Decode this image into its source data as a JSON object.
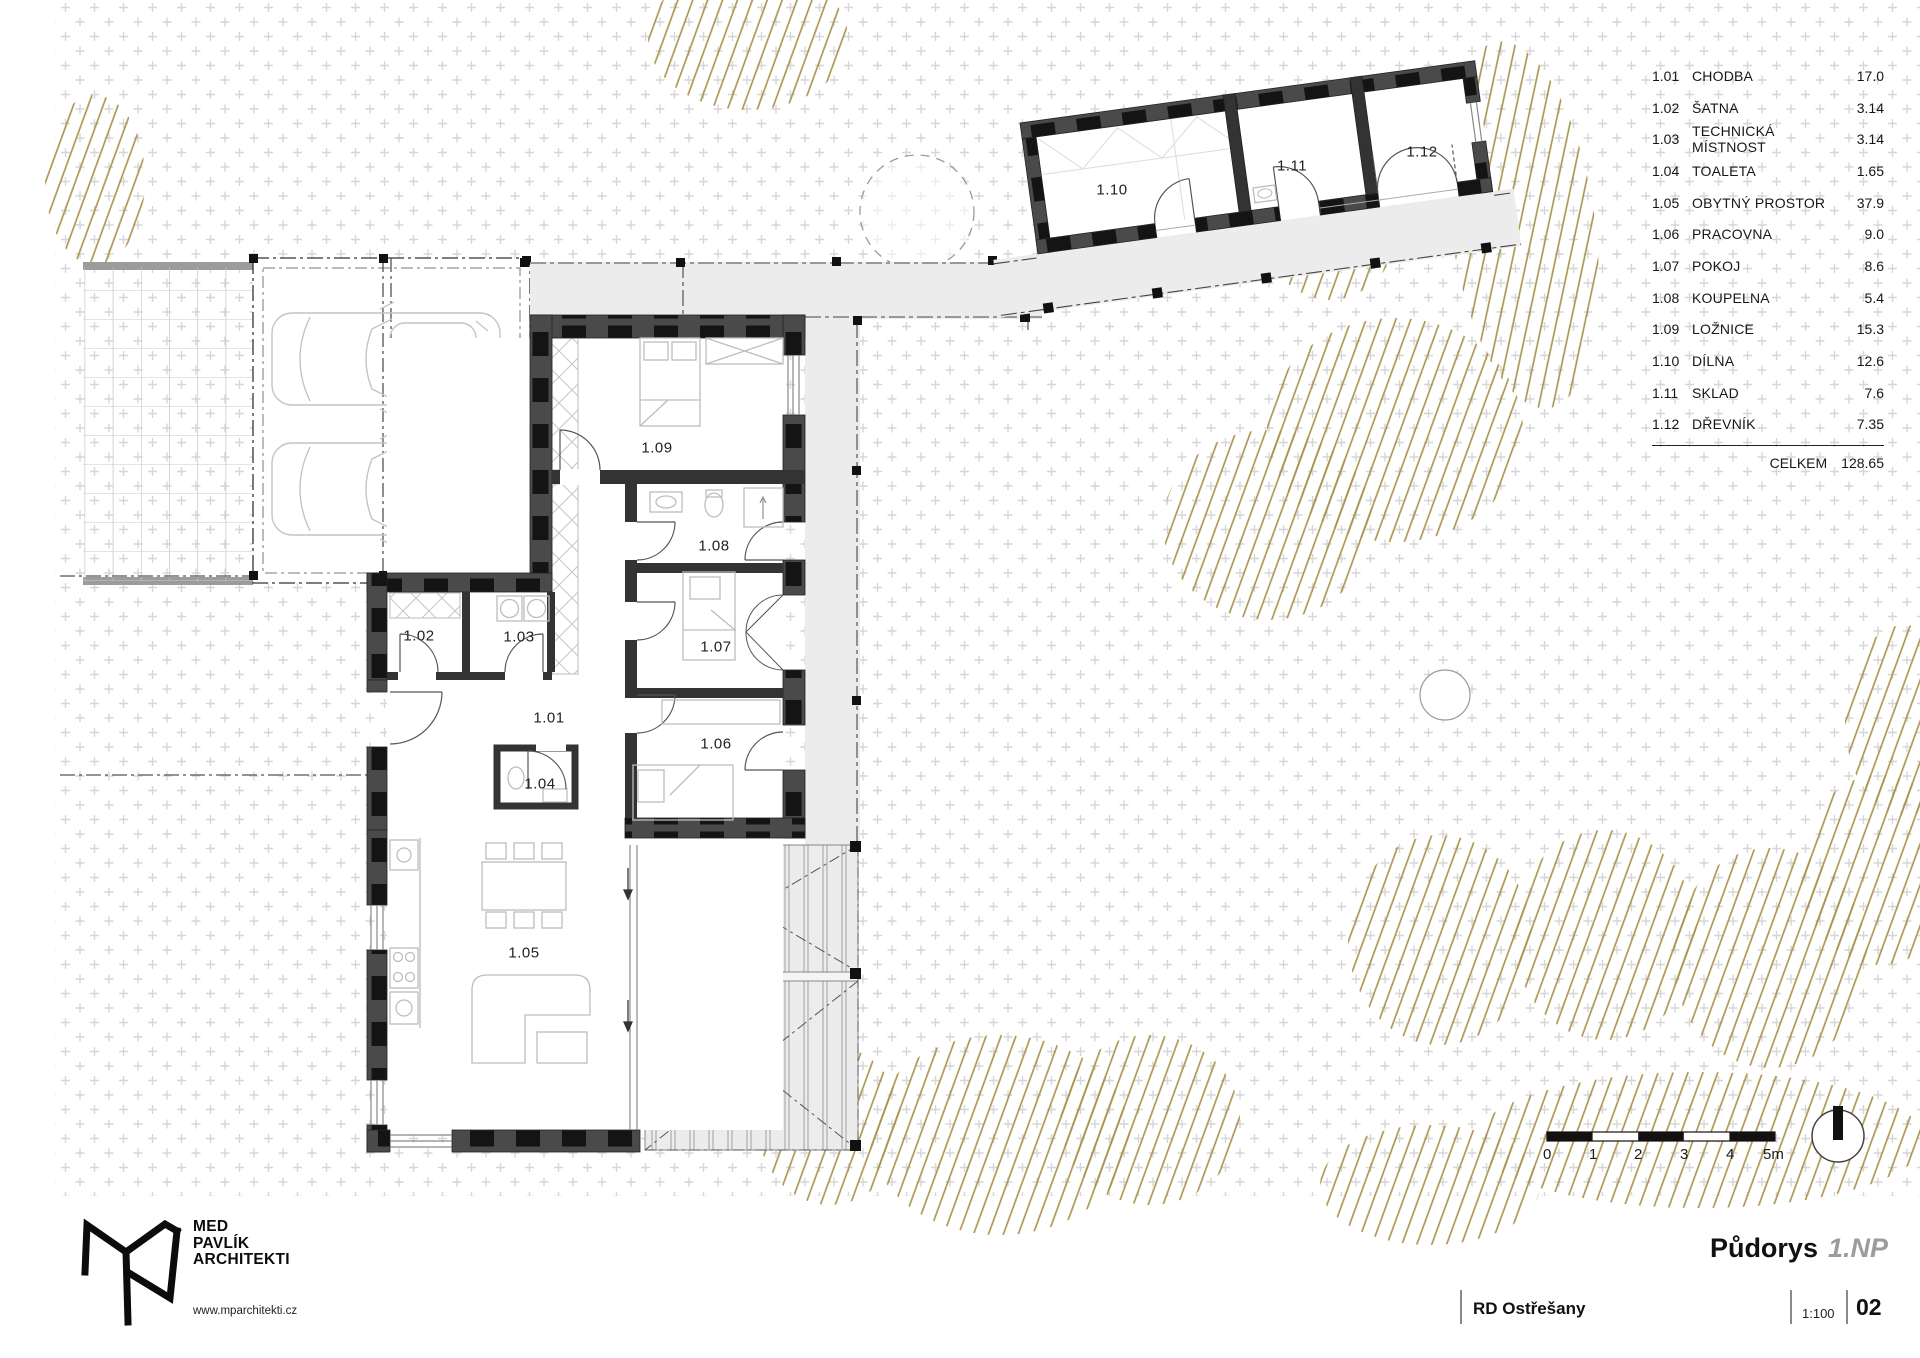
{
  "title_block": {
    "drawing_title": "Půdorys",
    "drawing_phase": "1.NP",
    "project_name": "RD Ostřešany",
    "scale": "1:100",
    "sheet_number": "02"
  },
  "legend": {
    "rows": [
      {
        "id": "1.01",
        "name": "CHODBA",
        "area": "17.0"
      },
      {
        "id": "1.02",
        "name": "ŠATNA",
        "area": "3.14"
      },
      {
        "id": "1.03",
        "name": "TECHNICKÁ MÍSTNOST",
        "area": "3.14"
      },
      {
        "id": "1.04",
        "name": "TOALETA",
        "area": "1.65"
      },
      {
        "id": "1.05",
        "name": "OBYTNÝ PROSTOR",
        "area": "37.9"
      },
      {
        "id": "1.06",
        "name": "PRACOVNA",
        "area": "9.0"
      },
      {
        "id": "1.07",
        "name": "POKOJ",
        "area": "8.6"
      },
      {
        "id": "1.08",
        "name": "KOUPELNA",
        "area": "5.4"
      },
      {
        "id": "1.09",
        "name": "LOŽNICE",
        "area": "15.3"
      },
      {
        "id": "1.10",
        "name": "DÍLNA",
        "area": "12.6"
      },
      {
        "id": "1.11",
        "name": "SKLAD",
        "area": "7.6"
      },
      {
        "id": "1.12",
        "name": "DŘEVNÍK",
        "area": "7.35"
      }
    ],
    "total_label": "CELKEM",
    "total_area": "128.65"
  },
  "plan": {
    "rooms": [
      {
        "id": "1.01"
      },
      {
        "id": "1.02"
      },
      {
        "id": "1.03"
      },
      {
        "id": "1.04"
      },
      {
        "id": "1.05"
      },
      {
        "id": "1.06"
      },
      {
        "id": "1.07"
      },
      {
        "id": "1.08"
      },
      {
        "id": "1.09"
      },
      {
        "id": "1.10"
      },
      {
        "id": "1.11"
      },
      {
        "id": "1.12"
      }
    ]
  },
  "scale_bar": {
    "labels": [
      "0",
      "1",
      "2",
      "3",
      "4",
      "5m"
    ]
  },
  "logo": {
    "line1": "MED",
    "line2": "PAVLÍK",
    "line3": "ARCHITEKTI",
    "website": "www.mparchitekti.cz"
  },
  "colors": {
    "vegetation_hatch": "#a8934a",
    "wall_fill": "#4a4a4a",
    "walkway_fill": "#ececec"
  }
}
